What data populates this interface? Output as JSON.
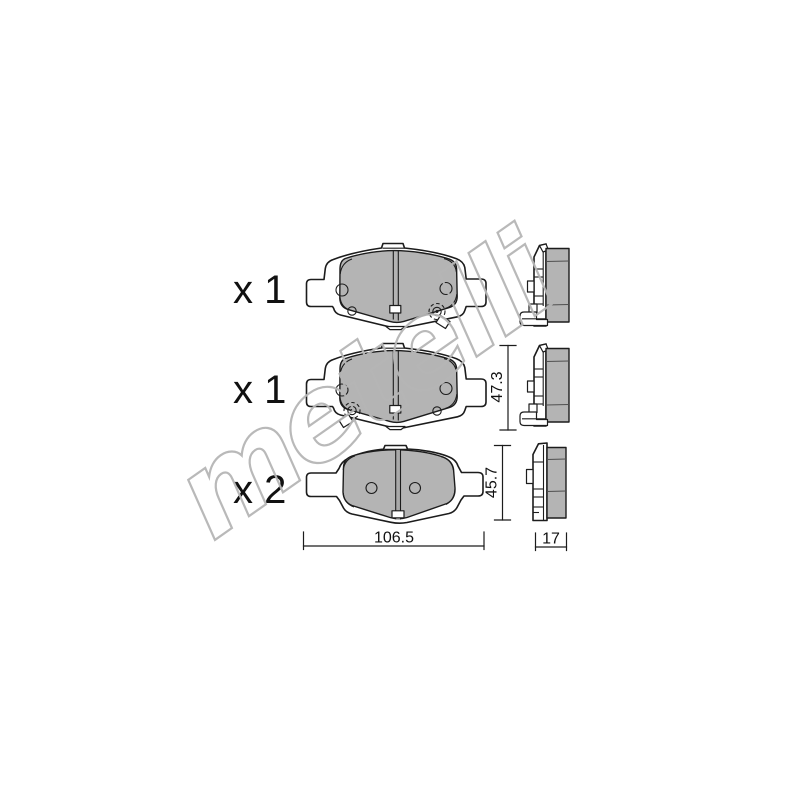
{
  "watermark": {
    "text": "metelli"
  },
  "parts": [
    {
      "quantity_label": "x 1"
    },
    {
      "quantity_label": "x 1"
    },
    {
      "quantity_label": "x 2"
    }
  ],
  "dimensions": {
    "middle_pad_height": "47.3",
    "bottom_pad_height": "45.7",
    "pad_width": "106.5",
    "pad_thickness": "17"
  },
  "colors": {
    "background": "#ffffff",
    "outline": "#1c1c1c",
    "text": "#111111",
    "friction_gray": "#b4b4b4",
    "slot_gray": "#a9a9a9",
    "detail_gray": "#4f4f4f",
    "watermark_gray": "#b6b6b6"
  }
}
